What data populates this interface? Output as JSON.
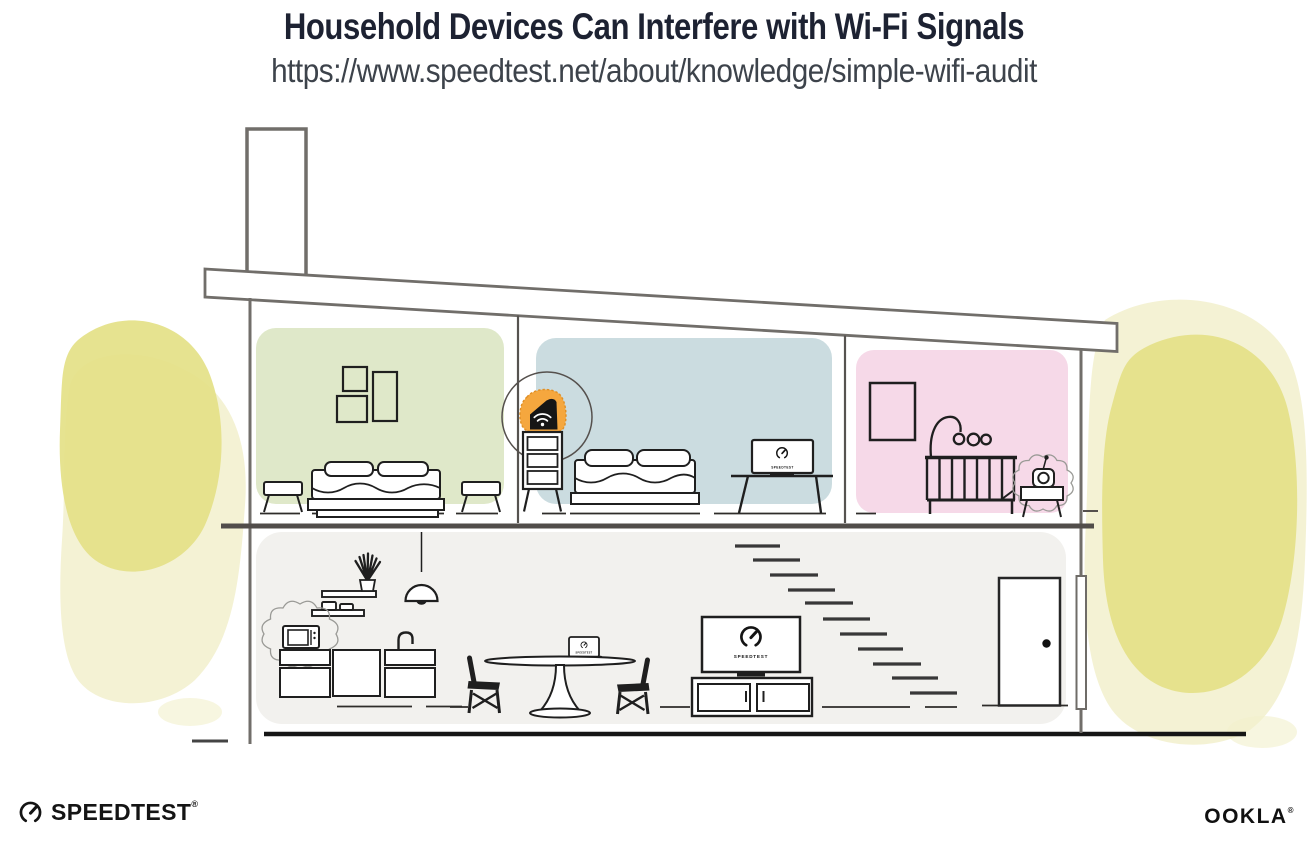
{
  "header": {
    "title": "Household Devices Can Interfere with Wi-Fi Signals",
    "url": "https://www.speedtest.net/about/knowledge/simple-wifi-audit"
  },
  "branding": {
    "speedtest_label": "SPEEDTEST",
    "ookla_label": "OOKLA",
    "reg_mark": "®"
  },
  "screens": {
    "speedtest_label": "SPEEDTEST"
  },
  "illustration": {
    "icons": {
      "router": "wifi-icon",
      "speed_test_screens": "speedtest-gauge-icon"
    },
    "interference_devices": [
      "microwave",
      "baby-monitor"
    ],
    "speedtest_screens": [
      "desktop-monitor",
      "laptop",
      "tv"
    ],
    "colors": {
      "router_highlight_orange": "#F5A73E",
      "bedroom_green": "#DFE8C9",
      "bedroom_blue": "#CBDCE0",
      "nursery_pink": "#F6D9E8",
      "lower_floor_gray": "#F2F1EE",
      "foliage_yellow": "#E4E187",
      "foliage_yellow_light": "#F2F0CC",
      "outline_gray": "#716E6A",
      "ink": "#1F1F1F",
      "title_navy": "#1D2232"
    }
  }
}
